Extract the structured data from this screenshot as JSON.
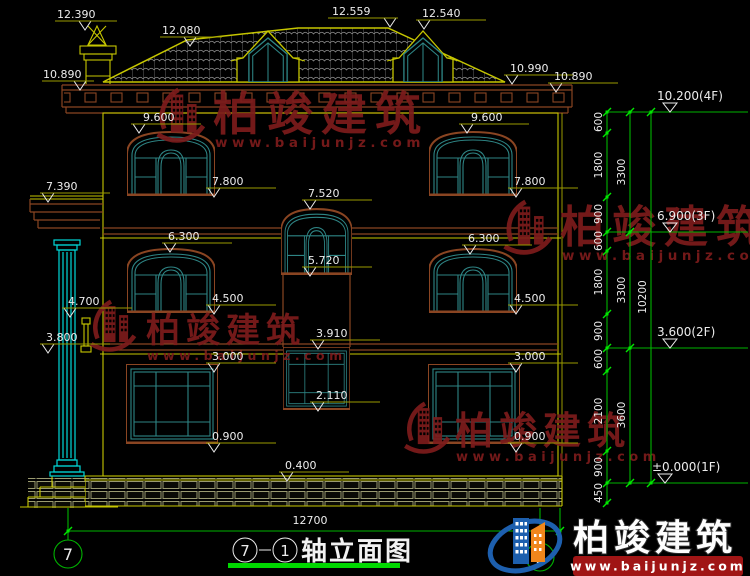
{
  "drawing_title": {
    "axis_from": "7",
    "axis_to": "1",
    "name": "轴立面图",
    "full": "⑦-①轴立面图"
  },
  "bottom_dim": "12700",
  "axis_bubbles": {
    "left": "7",
    "right": "1"
  },
  "levels": [
    "10.200(4F)",
    "6.900(3F)",
    "3.600(2F)",
    "±0.000(1F)"
  ],
  "dims": {
    "col1": [
      "600",
      "1800",
      "900",
      "600",
      "1800",
      "900",
      "600",
      "2100",
      "900",
      "450"
    ],
    "col2": [
      "3300",
      "3300",
      "3600"
    ],
    "total": "10200"
  },
  "annotations": {
    "chimney": "12.390",
    "roof_break": "12.080",
    "ridge": "12.559",
    "dormer_right": "12.540",
    "eave_left": "10.890",
    "eave_right_outer": "10.990",
    "eave_right_inner": "10.890",
    "porch_roof": "7.390",
    "porch_capital": "4.700",
    "porch_bracket": "3.800",
    "f3_left_head": "9.600",
    "f3_right_head": "9.600",
    "f3_left_sill": "7.800",
    "f3_right_sill": "7.800",
    "stair_upper_head": "7.520",
    "stair_upper_sill": "5.720",
    "f2_left_head": "6.300",
    "f2_right_head": "6.300",
    "f2_left_sill": "4.500",
    "f2_right_sill": "4.500",
    "stair_lower_head": "3.910",
    "stair_lower_sill": "2.110",
    "f1_left_head": "3.000",
    "f1_right_head": "3.000",
    "f1_left_sill": "0.900",
    "f1_right_sill": "0.900",
    "plinth": "0.400"
  },
  "watermark": {
    "brand": "柏竣建筑",
    "domain": "www.baijunjz.com"
  },
  "colors": {
    "cad_yellow": "#c6c600",
    "cad_green": "#00b400",
    "trim_brown": "#8a4522",
    "window_teal": "#2e8585",
    "column_cyan": "#00d8d8",
    "watermark_red": "#7d1c1c",
    "logo_blue": "#1d5fae",
    "logo_orange": "#f0861c"
  }
}
